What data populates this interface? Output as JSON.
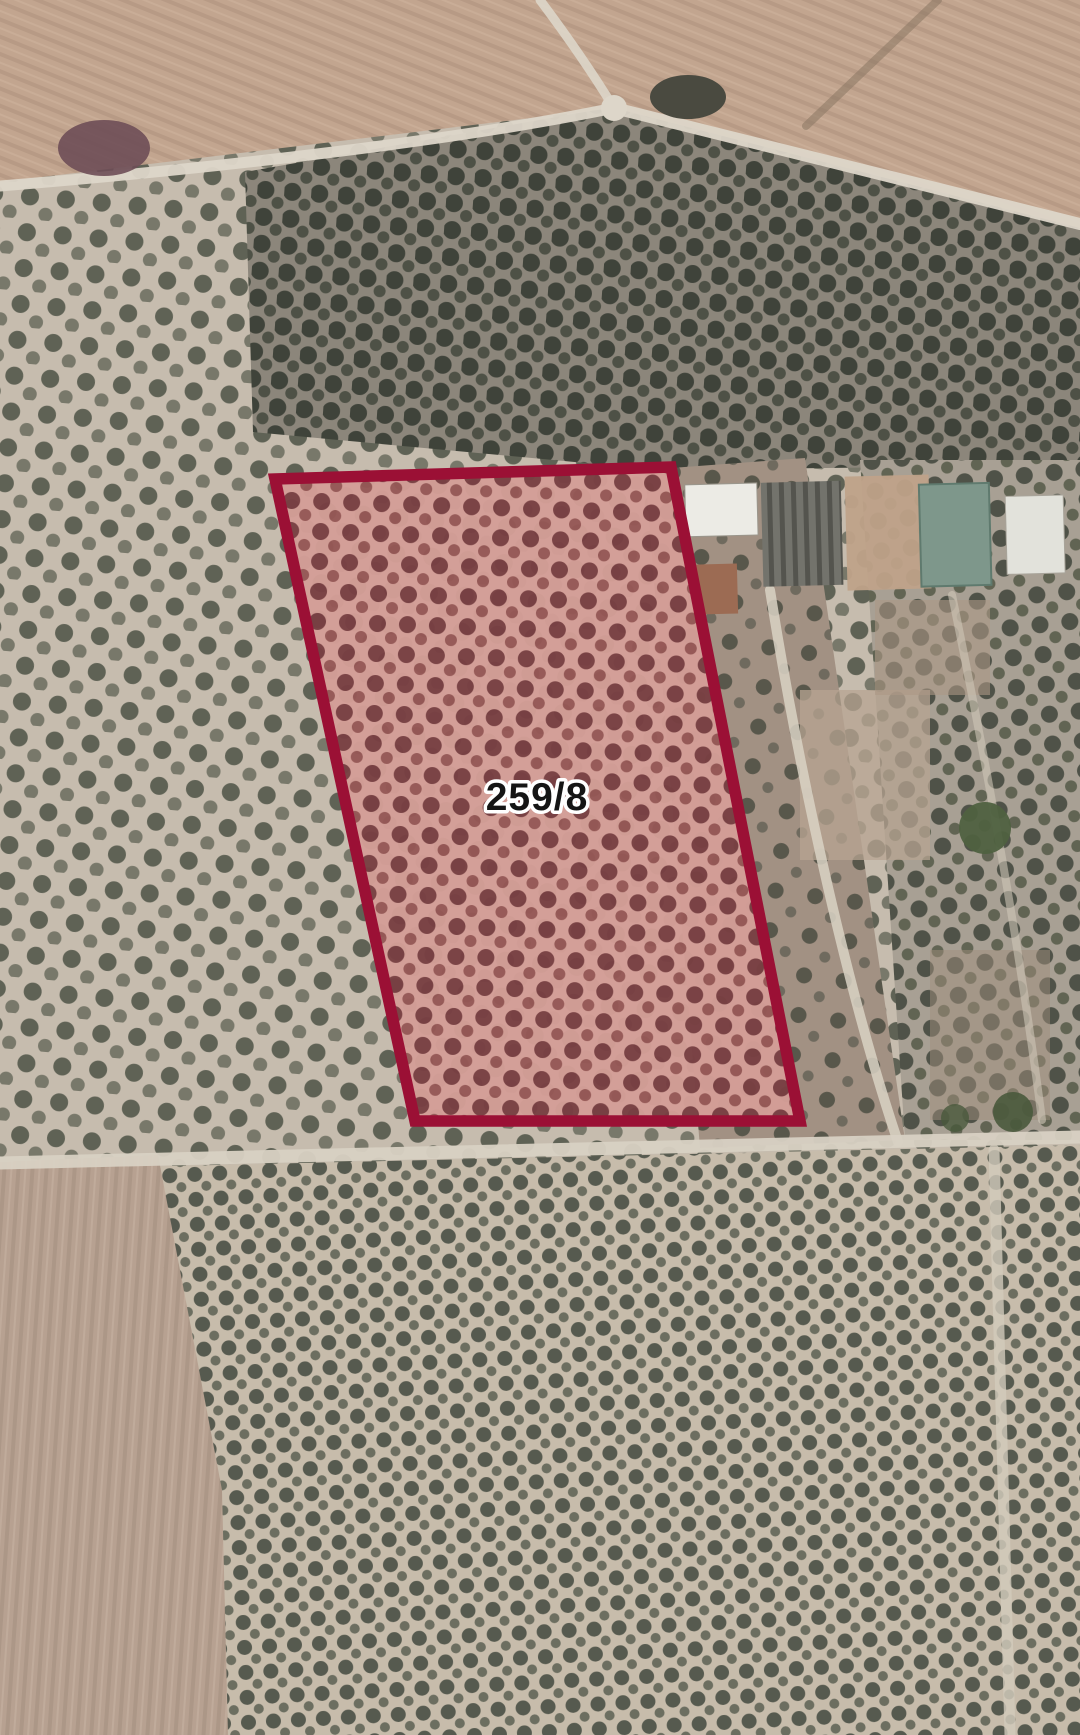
{
  "map": {
    "kind": "satellite-cadastral-view",
    "parcel": {
      "label": "259/8",
      "points": "275,479 671,467 800,1121 415,1121",
      "stroke_color": "#9b1035",
      "fill_tint": "#d49e97",
      "tree_dot_color": "#733a3d",
      "label_color": "#151515",
      "label_halo_color": "#ffffff"
    },
    "terrain_colors": {
      "plowed_field_top": "#c2a58f",
      "plowed_field_bottom_left": "#b7a191",
      "grove_soil_light": "#c6bcae",
      "grove_soil_mid": "#a8a094",
      "grove_soil_dark": "#8c867b",
      "grove_soil_bottom": "#c7bcab",
      "scrub_brown": "#a29183",
      "olive_tree_dark": "#3b3f37",
      "road_light": "#ddd6c9",
      "dirt_track": "#8e7965"
    },
    "features": {
      "buildings": [
        {
          "name": "white-roof-building",
          "color": "#ecebe5"
        },
        {
          "name": "corrugated-rows-structure",
          "color": "#73736c"
        },
        {
          "name": "farmyard",
          "color": "#bfa289"
        },
        {
          "name": "teal-roof-structure",
          "color": "#7e978b"
        },
        {
          "name": "white-roof-building-2",
          "color": "#e2e2db"
        },
        {
          "name": "red-roof-building",
          "color": "#9c6b53"
        }
      ]
    }
  }
}
